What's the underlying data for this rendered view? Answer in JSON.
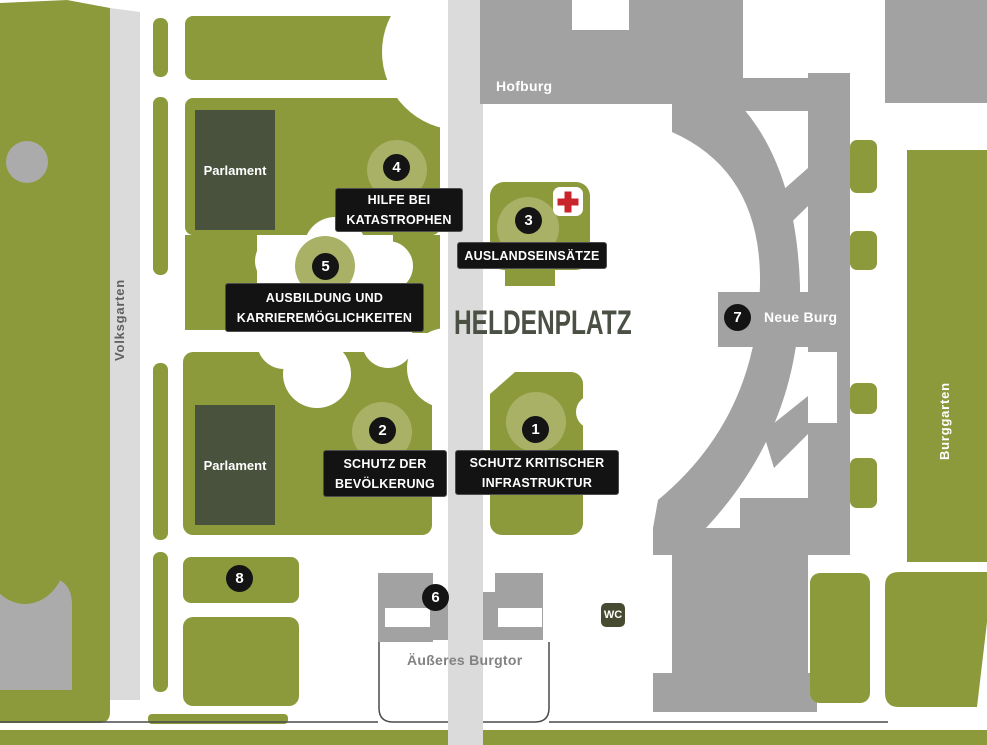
{
  "map_title": "HELDENPLATZ",
  "places": {
    "hofburg": "Hofburg",
    "volksgarten": "Volksgarten",
    "burggarten": "Burggarten",
    "parlament_north": "Parlament",
    "parlament_south": "Parlament",
    "aeusseres_burgtor": "Äußeres Burgtor",
    "neue_burg": "Neue Burg",
    "wc": "WC"
  },
  "stations": [
    {
      "number": "1",
      "lines": [
        "SCHUTZ KRITISCHER",
        "INFRASTRUKTUR"
      ]
    },
    {
      "number": "2",
      "lines": [
        "SCHUTZ DER",
        "BEVÖLKERUNG"
      ]
    },
    {
      "number": "3",
      "lines": [
        "AUSLANDSEINSÄTZE"
      ]
    },
    {
      "number": "4",
      "lines": [
        "HILFE BEI",
        "KATASTROPHEN"
      ]
    },
    {
      "number": "5",
      "lines": [
        "AUSBILDUNG UND",
        "KARRIEREMÖGLICHKEITEN"
      ]
    },
    {
      "number": "6",
      "lines": []
    },
    {
      "number": "7",
      "lines": []
    },
    {
      "number": "8",
      "lines": []
    }
  ],
  "icons": {
    "first_aid": "red-cross-first-aid"
  },
  "colors": {
    "park_green": "#8c9a3c",
    "halo_green": "#a9b166",
    "building_gray": "#a2a2a2",
    "road_gray": "#dbdbdb",
    "dark_building": "#49523c",
    "marker_black": "#141414",
    "title_text": "#4b5045",
    "cross_red": "#c9242b",
    "wc_badge_bg": "#464b31"
  }
}
